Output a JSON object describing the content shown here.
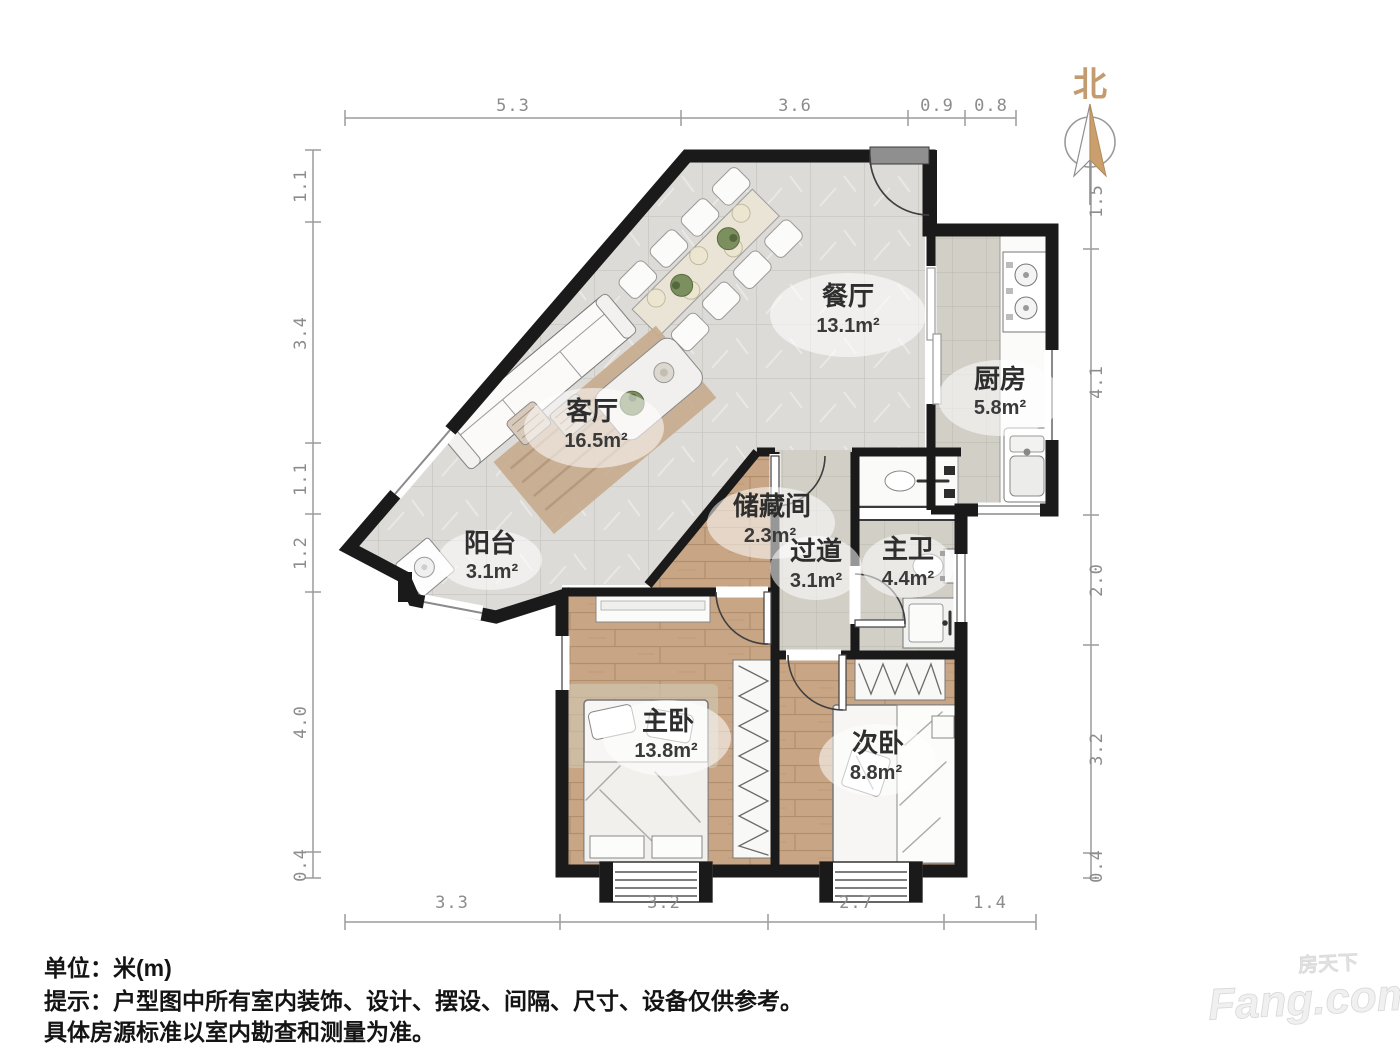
{
  "compass": {
    "north_label": "北"
  },
  "rulers": {
    "unit": "米(m)",
    "top": [
      "5.3",
      "3.6",
      "0.9",
      "0.8"
    ],
    "bottom": [
      "3.3",
      "3.2",
      "2.7",
      "1.4"
    ],
    "left": [
      "1.1",
      "3.4",
      "1.1",
      "1.2",
      "4.0",
      "0.4"
    ],
    "right": [
      "1.5",
      "4.1",
      "2.0",
      "3.2",
      "0.4"
    ]
  },
  "rooms": {
    "dining": {
      "name": "餐厅",
      "area": "13.1m²"
    },
    "kitchen": {
      "name": "厨房",
      "area": "5.8m²"
    },
    "living": {
      "name": "客厅",
      "area": "16.5m²"
    },
    "balcony": {
      "name": "阳台",
      "area": "3.1m²"
    },
    "storage": {
      "name": "储藏间",
      "area": "2.3m²"
    },
    "hallway": {
      "name": "过道",
      "area": "3.1m²"
    },
    "master_bath": {
      "name": "主卫",
      "area": "4.4m²"
    },
    "master_bedroom": {
      "name": "主卧",
      "area": "13.8m²"
    },
    "second_bedroom": {
      "name": "次卧",
      "area": "8.8m²"
    }
  },
  "footer": {
    "unit_line": "单位：米(m)",
    "notice_line1": "提示：户型图中所有室内装饰、设计、摆设、间隔、尺寸、设备仅供参考。",
    "notice_line2": "具体房源标准以室内勘查和测量为准。"
  },
  "watermark": {
    "brand_cn": "房天下",
    "brand_en": "Fang.com"
  },
  "colors": {
    "wall": "#1a1a1a",
    "marble_floor": "#dddbd7",
    "tile_floor": "#d2cfc7",
    "wood_floor": "#c8a585",
    "compass_tan": "#c9a06d",
    "dimension_text": "#8c8c8c",
    "watermark_gray": "#efefef"
  }
}
